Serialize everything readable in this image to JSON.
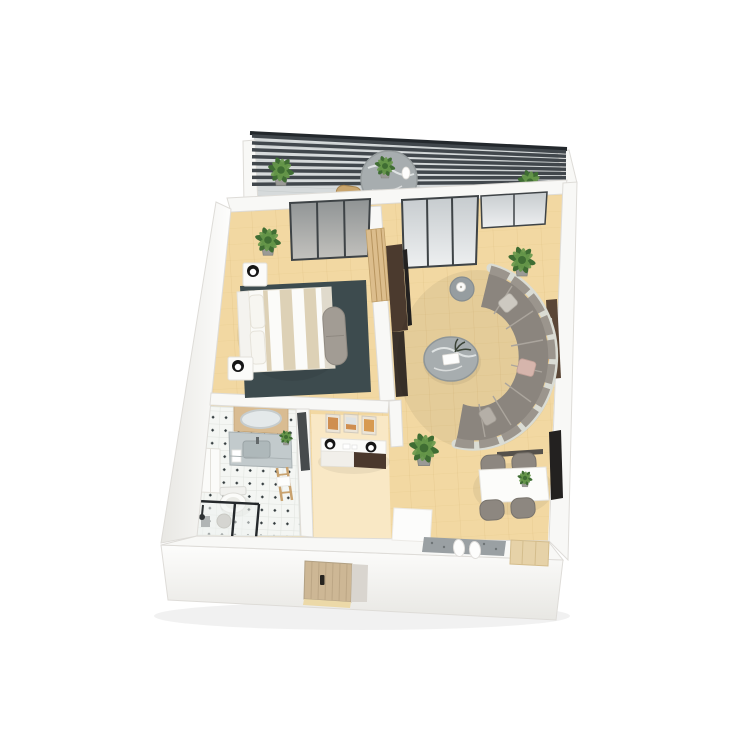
{
  "scene": {
    "type": "3d-floorplan-render",
    "view": "isometric-top-down",
    "description": "White-walled one-bedroom apartment 3D floor plan with balcony, bedroom, living-dining room, entry hall and bathroom"
  },
  "colors": {
    "background": "#ffffff",
    "wallTop": "#f8f8f6",
    "wallEdge": "#dedcd8",
    "floorWood": "#f2d8a2",
    "floorEntry": "#f9e8c5",
    "balconyFloor": "#d6dadb",
    "balconyDeckLine": "#c4c9ca",
    "pergolaSlat": "#41474c",
    "pergolaRail": "#23282c",
    "glassDark": "#c6cbce",
    "glassLight": "#eef0f1",
    "bedGlassDark": "#8f9394",
    "bedGlassLight": "#c3c2be",
    "glassFrame": "#3e4346",
    "rugDark": "#3d4b4e",
    "bedStripe": "#ddd1b6",
    "headboard": "#f4f3ef",
    "benchGray": "#a29c94",
    "lampBlack": "#161616",
    "lampWhite": "#ffffff",
    "slatPanelWood": "#dcbd8c",
    "mediaUnit": "#4b3a2e",
    "tvBlack": "#232120",
    "sofaCushion": "#8b857e",
    "sofaFrame": "#dadcd4",
    "sofaBack": "#9b958d",
    "sofaSeam": "#aba59d",
    "pillowBlush": "#d6b5ac",
    "pillowLight": "#cdc9c1",
    "marbleGray": "#a7adaf",
    "marbleVein": "#eef0f0",
    "sideTable": "#969da0",
    "tableWhite": "#fcfcfa",
    "chairGray": "#8d8780",
    "shelfWoodConsole": "#5a4636",
    "bookOrange": "#c07840",
    "tileBase": "#f4f6f3",
    "tileLine": "#dfe3de",
    "tileDot": "#31393b",
    "vanityMarble": "#c2cacc",
    "backsplashWood": "#d9bc92",
    "mirrorGlass": "#e4e9ea",
    "fixtureWhite": "#fbfbf9",
    "doorWood": "#cdb795",
    "doorPlank": "#b9a382",
    "doormat": "#9aa0a3",
    "rugWhite": "#fcfcfb",
    "matWood": "#e6d2a8",
    "plantDark": "#3f6d33",
    "plantLight": "#67984a",
    "potGray": "#9a9a96",
    "consoleDark": "#4a382c",
    "chairWoodBalcony": "#c9a56d",
    "shadow": "#000000"
  },
  "rooms": [
    {
      "name": "balcony",
      "furniture": [
        "pergola-slats",
        "round-marble-table",
        "table-plant",
        "white-jug",
        "outdoor-chair-left",
        "outdoor-chair-right",
        "potted-plant-left",
        "potted-plant-right"
      ]
    },
    {
      "name": "bedroom",
      "furniture": [
        "sliding-glass-door",
        "double-bed-striped-duvet",
        "headboard",
        "pillows",
        "nightstand-north",
        "nightstand-south",
        "black-white-lamps",
        "bench-ottoman",
        "dark-area-rug",
        "wood-slat-wardrobe-panel",
        "corner-plant"
      ]
    },
    {
      "name": "living-room",
      "furniture": [
        "sliding-glass-doors",
        "curved-sectional-sofa",
        "accent-pillows",
        "round-marble-coffee-table",
        "decor-books",
        "side-table-with-lamp",
        "tv-media-wall",
        "right-wall-console",
        "wall-door-handle",
        "palm-plant-north",
        "palm-plant-hall"
      ]
    },
    {
      "name": "dining-area",
      "furniture": [
        "white-dining-table",
        "dining-chairs-x4",
        "table-plant",
        "wall-shelf",
        "wall-tv",
        "doormat",
        "slippers",
        "white-rug",
        "wood-entry-mat"
      ]
    },
    {
      "name": "entry-hall",
      "furniture": [
        "console-sideboard",
        "black-white-lamps",
        "picture-frames-x3",
        "decor-objects"
      ]
    },
    {
      "name": "bathroom",
      "furniture": [
        "tiled-floor",
        "vanity-with-sink",
        "wood-backsplash",
        "oval-mirror",
        "vanity-plant",
        "tall-cabinet",
        "toilet",
        "stool",
        "bucket",
        "shower-glass-enclosure",
        "towel-ladder",
        "dark-door"
      ]
    },
    {
      "name": "exterior",
      "furniture": [
        "entry-door",
        "door-handle",
        "threshold"
      ]
    }
  ]
}
